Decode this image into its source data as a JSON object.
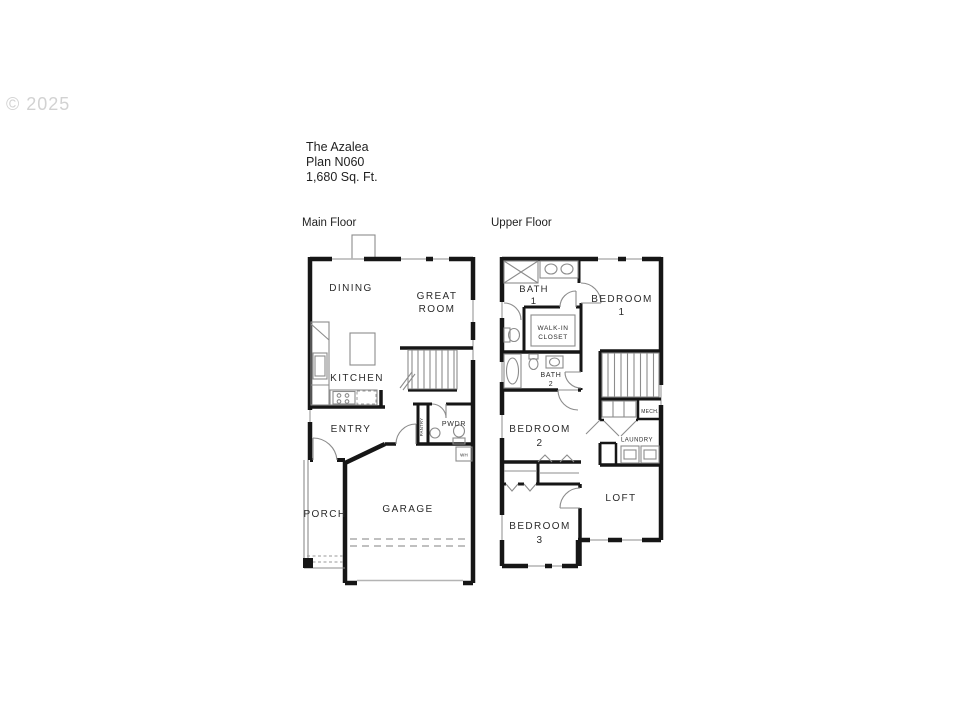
{
  "watermark": "© 2025",
  "title": {
    "name": "The Azalea",
    "plan": "Plan N060",
    "sqft": "1,680 Sq. Ft."
  },
  "floor_labels": {
    "main": "Main Floor",
    "upper": "Upper Floor"
  },
  "main_floor": {
    "dining": "DINING",
    "great_room_line1": "GREAT",
    "great_room_line2": "ROOM",
    "kitchen": "KITCHEN",
    "entry": "ENTRY",
    "powder": "PWDR",
    "pantry": "PANTRY",
    "water_heater": "WH",
    "garage": "GARAGE",
    "porch": "PORCH"
  },
  "upper_floor": {
    "bath1_line1": "BATH",
    "bath1_line2": "1",
    "bedroom1_line1": "BEDROOM",
    "bedroom1_line2": "1",
    "walkin_line1": "WALK-IN",
    "walkin_line2": "CLOSET",
    "bath2_line1": "BATH",
    "bath2_line2": "2",
    "bedroom2_line1": "BEDROOM",
    "bedroom2_line2": "2",
    "bedroom3_line1": "BEDROOM",
    "bedroom3_line2": "3",
    "mech": "MECH.",
    "laundry": "LAUNDRY",
    "loft": "LOFT"
  },
  "colors": {
    "walls": "#161616",
    "fixtures": "#8c8c8c",
    "windows": "#b4b4b4",
    "text": "#2b2b2b",
    "watermark": "#d2d2d2",
    "background": "#ffffff"
  }
}
